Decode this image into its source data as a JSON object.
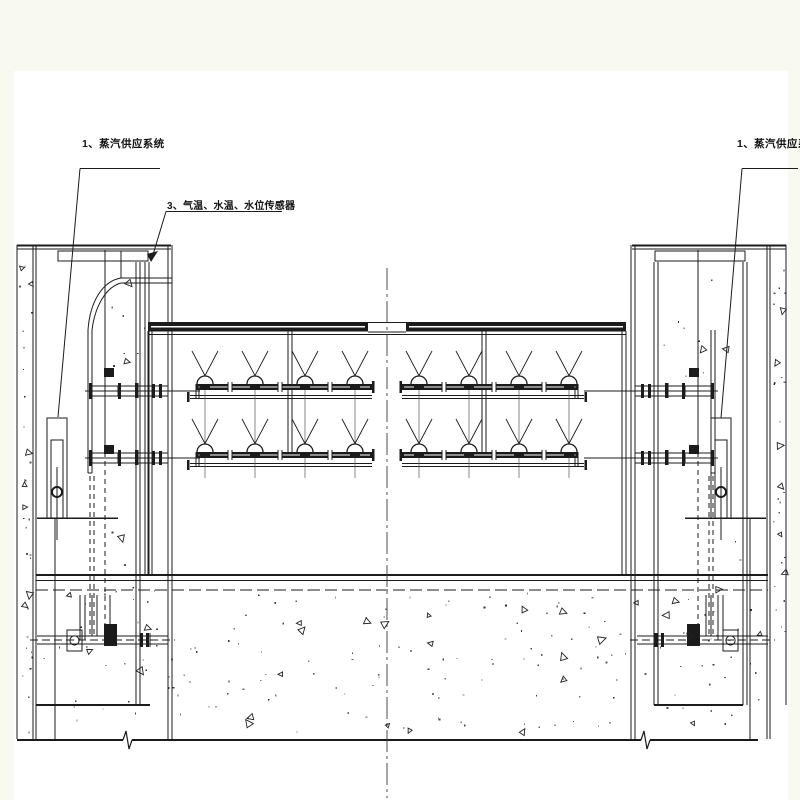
{
  "page": {
    "background": "#f8faf2",
    "canvas_background": "#ffffff",
    "line_color": "#1b1b1b",
    "centerline_color": "#3a3a3a"
  },
  "annotations": {
    "steam_supply_left": {
      "label": "1、蒸汽供应系统"
    },
    "sensors": {
      "label": "3、气温、水温、水位传感器"
    },
    "steam_supply_right": {
      "label": "1、蒸汽供应系统"
    }
  }
}
